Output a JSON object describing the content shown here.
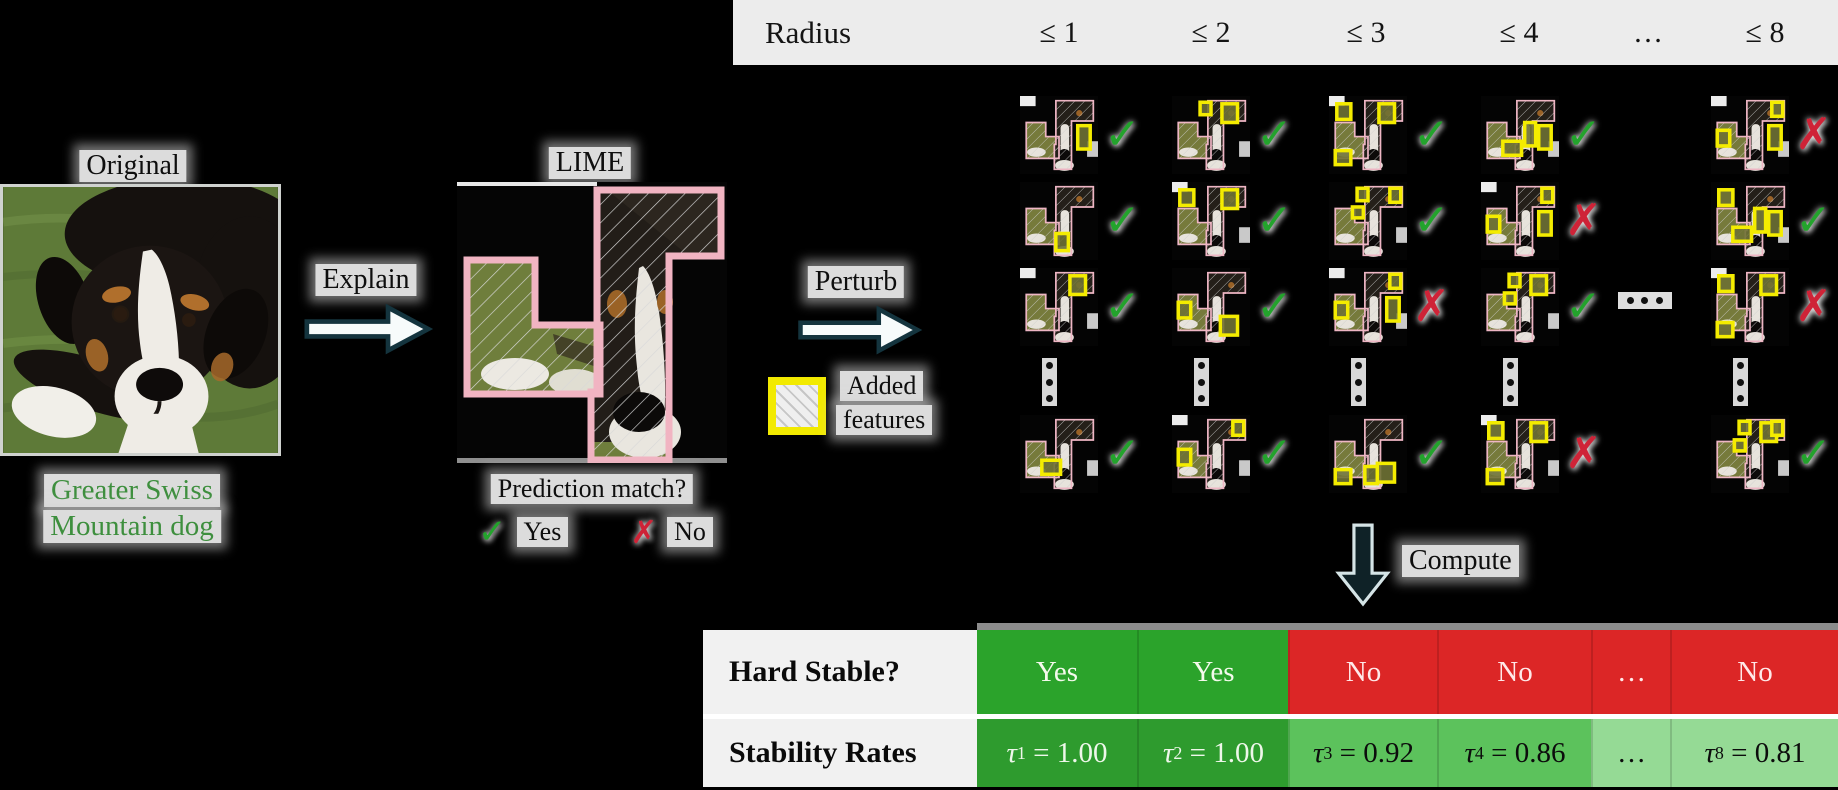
{
  "left_panel": {
    "title": "Original",
    "caption_line1": "Greater Swiss",
    "caption_line2": "Mountain dog"
  },
  "explain_arrow": {
    "label": "Explain"
  },
  "lime_panel": {
    "title": "LIME",
    "question": "Prediction match?",
    "yes_label": "Yes",
    "no_label": "No"
  },
  "perturb_arrow": {
    "label": "Perturb"
  },
  "legend": {
    "line1": "Added",
    "line2": "features"
  },
  "radius_header": {
    "label": "Radius",
    "columns": [
      "≤ 1",
      "≤ 2",
      "≤ 3",
      "≤ 4",
      "…",
      "≤ 8"
    ]
  },
  "grid": {
    "ellipsis_horizontal": "…",
    "ellipsis_vertical": "⋮",
    "rows": [
      {
        "marks": [
          "check",
          "check",
          "check",
          "check",
          "cross"
        ]
      },
      {
        "marks": [
          "check",
          "check",
          "check",
          "cross",
          "check"
        ]
      },
      {
        "marks": [
          "check",
          "check",
          "cross",
          "check",
          "cross"
        ]
      },
      {
        "marks": [
          "check",
          "check",
          "check",
          "cross",
          "check"
        ]
      }
    ]
  },
  "compute_arrow": {
    "label": "Compute"
  },
  "table": {
    "hard_stable": {
      "label": "Hard Stable?",
      "cells": [
        {
          "text": "Yes",
          "status": "yes"
        },
        {
          "text": "Yes",
          "status": "yes"
        },
        {
          "text": "No",
          "status": "no"
        },
        {
          "text": "No",
          "status": "no"
        },
        {
          "text": "…",
          "status": "no"
        },
        {
          "text": "No",
          "status": "no"
        }
      ]
    },
    "stability_rates": {
      "label": "Stability Rates",
      "cells": [
        {
          "symbol": "τ",
          "subscript": "1",
          "value": "1.00",
          "shade": "dark"
        },
        {
          "symbol": "τ",
          "subscript": "2",
          "value": "1.00",
          "shade": "dark"
        },
        {
          "symbol": "τ",
          "subscript": "3",
          "value": "0.92",
          "shade": "medium"
        },
        {
          "symbol": "τ",
          "subscript": "4",
          "value": "0.86",
          "shade": "medium"
        },
        {
          "text": "…",
          "shade": "light"
        },
        {
          "symbol": "τ",
          "subscript": "8",
          "value": "0.81",
          "shade": "light"
        }
      ]
    }
  },
  "icons": {
    "check": "✓",
    "cross": "✗"
  },
  "colors": {
    "header_band": "#ececec",
    "green_cell": "#2ba32b",
    "green_dark": "#2e9b2e",
    "green_mid": "#5cc25c",
    "green_light": "#95da95",
    "red_cell": "#dc2626",
    "check_green": "#23a32c",
    "cross_red": "#cf2337",
    "added_feature_yellow": "#f2ea00",
    "lime_pink": "#f1b4c2",
    "caption_green": "#3e8f3e"
  }
}
